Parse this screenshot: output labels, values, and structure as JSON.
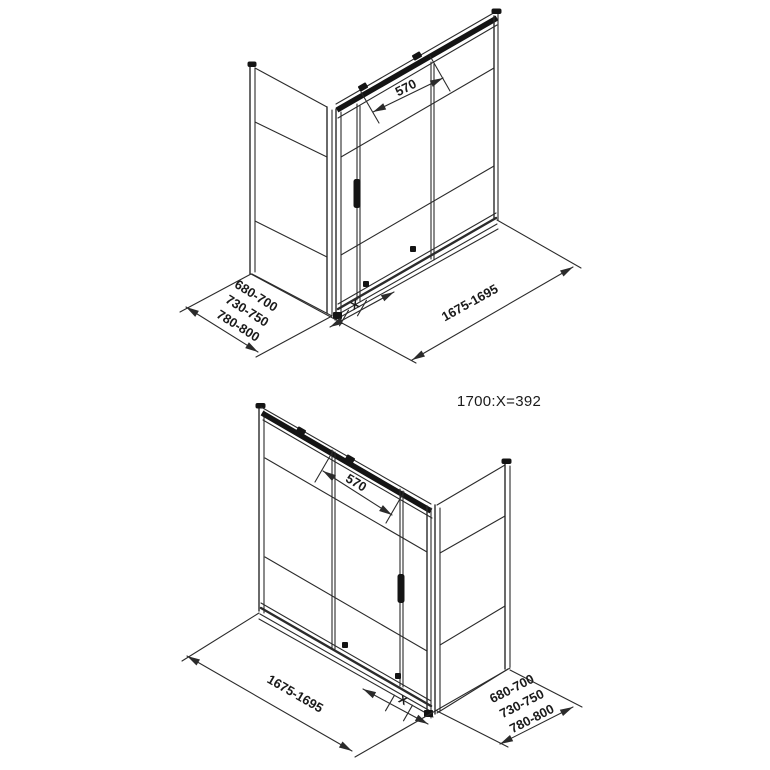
{
  "colors": {
    "line": "#2b2b2b",
    "dark_fill": "#141414",
    "text": "#1a1a1a",
    "background": "#ffffff"
  },
  "formula": {
    "text": "1700:X=392"
  },
  "top_drawing": {
    "door_width_label": "570",
    "total_width_label": "1675-1695",
    "adjustment_label": "X",
    "depth_range_labels": [
      "680-700",
      "730-750",
      "780-800"
    ]
  },
  "bottom_drawing": {
    "door_width_label": "570",
    "total_width_label": "1675-1695",
    "adjustment_label": "X",
    "depth_range_labels": [
      "680-700",
      "730-750",
      "780-800"
    ]
  }
}
